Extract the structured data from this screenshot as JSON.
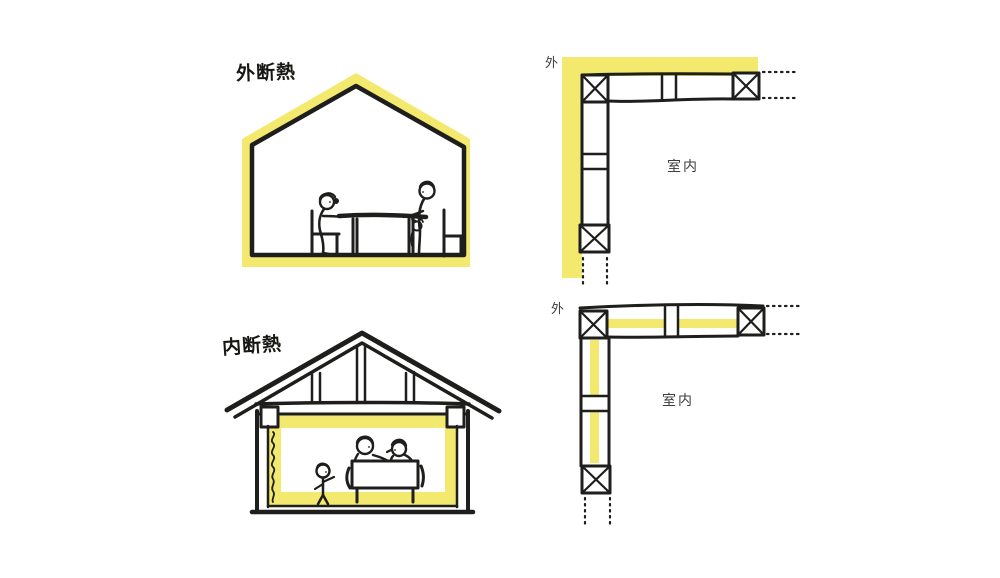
{
  "title": "insulation-comparison-sketch",
  "colors": {
    "insulation_yellow": "#f3e96e",
    "ink_black": "#1e1e1c",
    "label_gray": "#3d3d3d",
    "background": "#ffffff"
  },
  "figures": {
    "exterior_house": {
      "label": "外断熱"
    },
    "interior_house": {
      "label": "内断熱"
    },
    "exterior_detail": {
      "outside_label": "外",
      "room_label": "室内"
    },
    "interior_detail": {
      "outside_label": "外",
      "room_label": "室内"
    }
  }
}
